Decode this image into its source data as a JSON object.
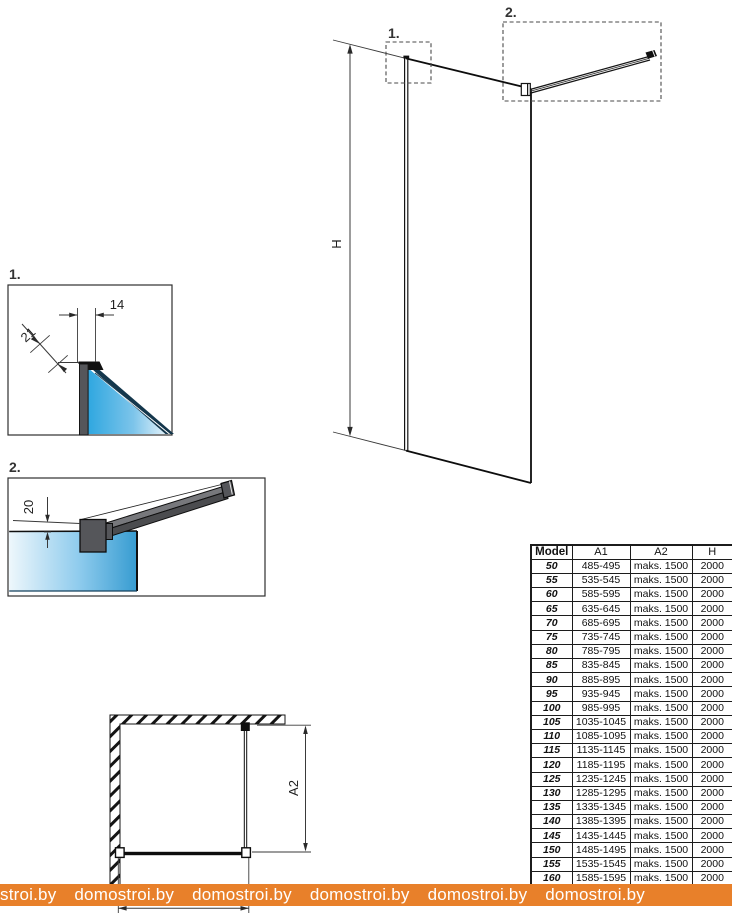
{
  "drawing": {
    "main_view": {
      "detail_1_label": "1.",
      "detail_2_label": "2.",
      "height_dim_label": "H"
    },
    "detail_1": {
      "title": "1.",
      "dim_top_label": "14",
      "dim_diag_label": "21"
    },
    "detail_2": {
      "title": "2.",
      "dim_gap_label": "20"
    },
    "plan_view": {
      "dim_depth_label": "A2"
    }
  },
  "table": {
    "headers": [
      "Model",
      "A1",
      "A2",
      "H"
    ],
    "rows": [
      [
        "50",
        "485-495",
        "maks. 1500",
        "2000"
      ],
      [
        "55",
        "535-545",
        "maks. 1500",
        "2000"
      ],
      [
        "60",
        "585-595",
        "maks. 1500",
        "2000"
      ],
      [
        "65",
        "635-645",
        "maks. 1500",
        "2000"
      ],
      [
        "70",
        "685-695",
        "maks. 1500",
        "2000"
      ],
      [
        "75",
        "735-745",
        "maks. 1500",
        "2000"
      ],
      [
        "80",
        "785-795",
        "maks. 1500",
        "2000"
      ],
      [
        "85",
        "835-845",
        "maks. 1500",
        "2000"
      ],
      [
        "90",
        "885-895",
        "maks. 1500",
        "2000"
      ],
      [
        "95",
        "935-945",
        "maks. 1500",
        "2000"
      ],
      [
        "100",
        "985-995",
        "maks. 1500",
        "2000"
      ],
      [
        "105",
        "1035-1045",
        "maks. 1500",
        "2000"
      ],
      [
        "110",
        "1085-1095",
        "maks. 1500",
        "2000"
      ],
      [
        "115",
        "1135-1145",
        "maks. 1500",
        "2000"
      ],
      [
        "120",
        "1185-1195",
        "maks. 1500",
        "2000"
      ],
      [
        "125",
        "1235-1245",
        "maks. 1500",
        "2000"
      ],
      [
        "130",
        "1285-1295",
        "maks. 1500",
        "2000"
      ],
      [
        "135",
        "1335-1345",
        "maks. 1500",
        "2000"
      ],
      [
        "140",
        "1385-1395",
        "maks. 1500",
        "2000"
      ],
      [
        "145",
        "1435-1445",
        "maks. 1500",
        "2000"
      ],
      [
        "150",
        "1485-1495",
        "maks. 1500",
        "2000"
      ],
      [
        "155",
        "1535-1545",
        "maks. 1500",
        "2000"
      ],
      [
        "160",
        "1585-1595",
        "maks. 1500",
        "2000"
      ]
    ]
  },
  "watermark": {
    "segments": [
      "stroi.by",
      "domostroi.by",
      "domostroi.by",
      "domostroi.by",
      "domostroi.by",
      "domostroi.by"
    ]
  },
  "colors": {
    "glass_blue": "#2fa7e0",
    "glass_pale": "#eef7fc",
    "glass_edge_navy": "#14374c",
    "hardware_gray": "#55565a",
    "line_black": "#111111",
    "watermark_orange": "#e8802a",
    "watermark_text": "#ffffff"
  }
}
